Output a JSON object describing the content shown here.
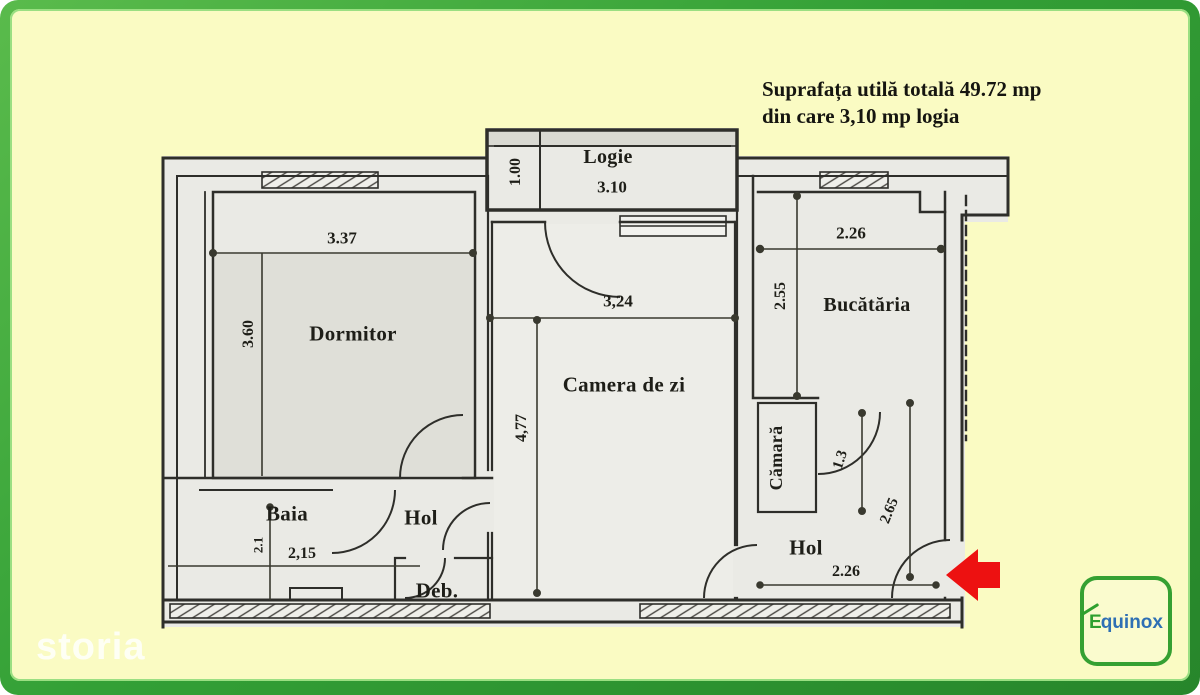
{
  "summary": {
    "line1": "Suprafața utilă totală 49.72 mp",
    "line2": "din care 3,10 mp logia"
  },
  "rooms": {
    "logie": "Logie",
    "dormitor": "Dormitor",
    "camera_de_zi": "Camera de zi",
    "bucataria": "Bucătăria",
    "camara": "Cămară",
    "baia": "Baia",
    "hol_mic": "Hol",
    "hol_intrare": "Hol",
    "debara": "Deb."
  },
  "dims": {
    "logie_latime": "3.10",
    "logie_adancime": "1.00",
    "dormitor_latime": "3.37",
    "dormitor_inaltime": "3.60",
    "camera_latime": "3,24",
    "camera_inaltime": "4,77",
    "bucataria_latime": "2.26",
    "bucataria_inaltime": "2.55",
    "camara_latime": "1.3",
    "hol_inaltime": "2.65",
    "hol_latime": "2.26",
    "baia_latime": "2,15",
    "baia_inaltime": "2.1"
  },
  "watermark": "storia",
  "logo": {
    "brand": "Equinox",
    "initial": "E",
    "rest": "quinox"
  },
  "colors": {
    "frame_green": "#33A036",
    "card_yellow": "#FAFBC3",
    "paper_gray": "#EAEAE5",
    "line_dark": "#2E2E2A",
    "arrow_red": "#ED1111",
    "logo_green": "#2FA02F",
    "logo_blue": "#2E6FB4",
    "watermark_white": "#FFFFFF"
  }
}
